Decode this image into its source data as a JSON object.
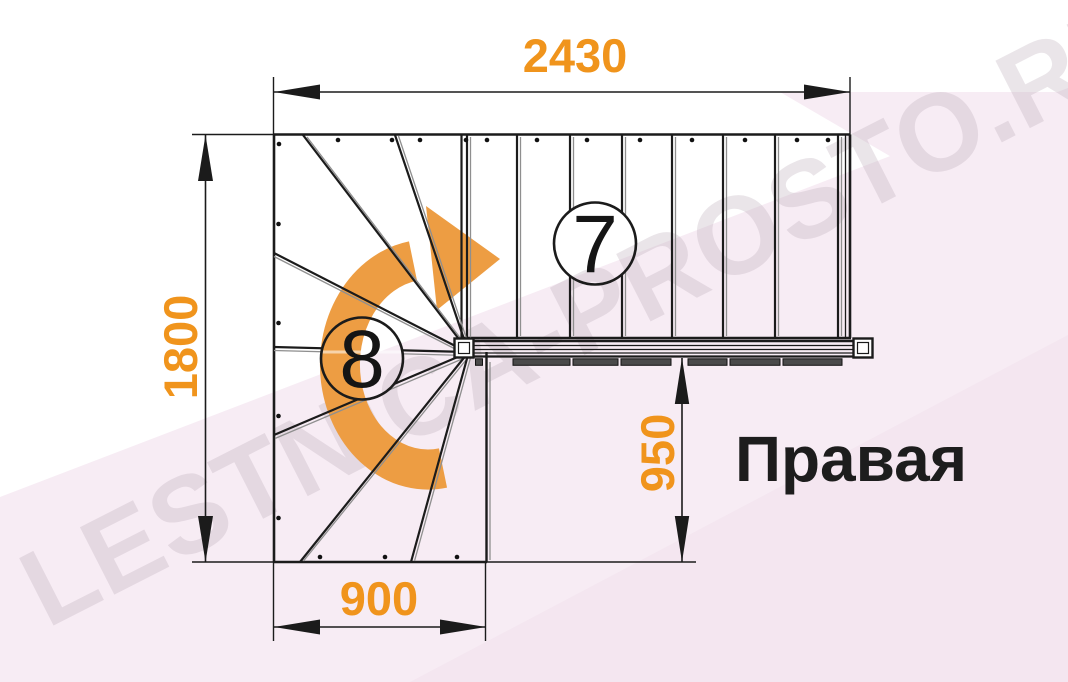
{
  "diagram": {
    "kind": "staircase-plan",
    "direction_label": "Правая",
    "upper_flight": {
      "step_count_label": "7"
    },
    "winder_flight": {
      "step_count_label": "8"
    },
    "rotation": "clockwise"
  },
  "dimensions": {
    "total_length_mm": "2430",
    "total_depth_mm": "1800",
    "exit_width_mm": "950",
    "entry_width_mm": "900"
  },
  "watermark": {
    "text": "LESTNICA-PROSTO.RU"
  },
  "colors": {
    "dimension_text": "#F0941C",
    "rotation_arrow": "#ED9D43",
    "linework": "#1b1b1b",
    "background_tint": "#f7ecf4",
    "background_tint_dark": "#f2e2ec"
  }
}
